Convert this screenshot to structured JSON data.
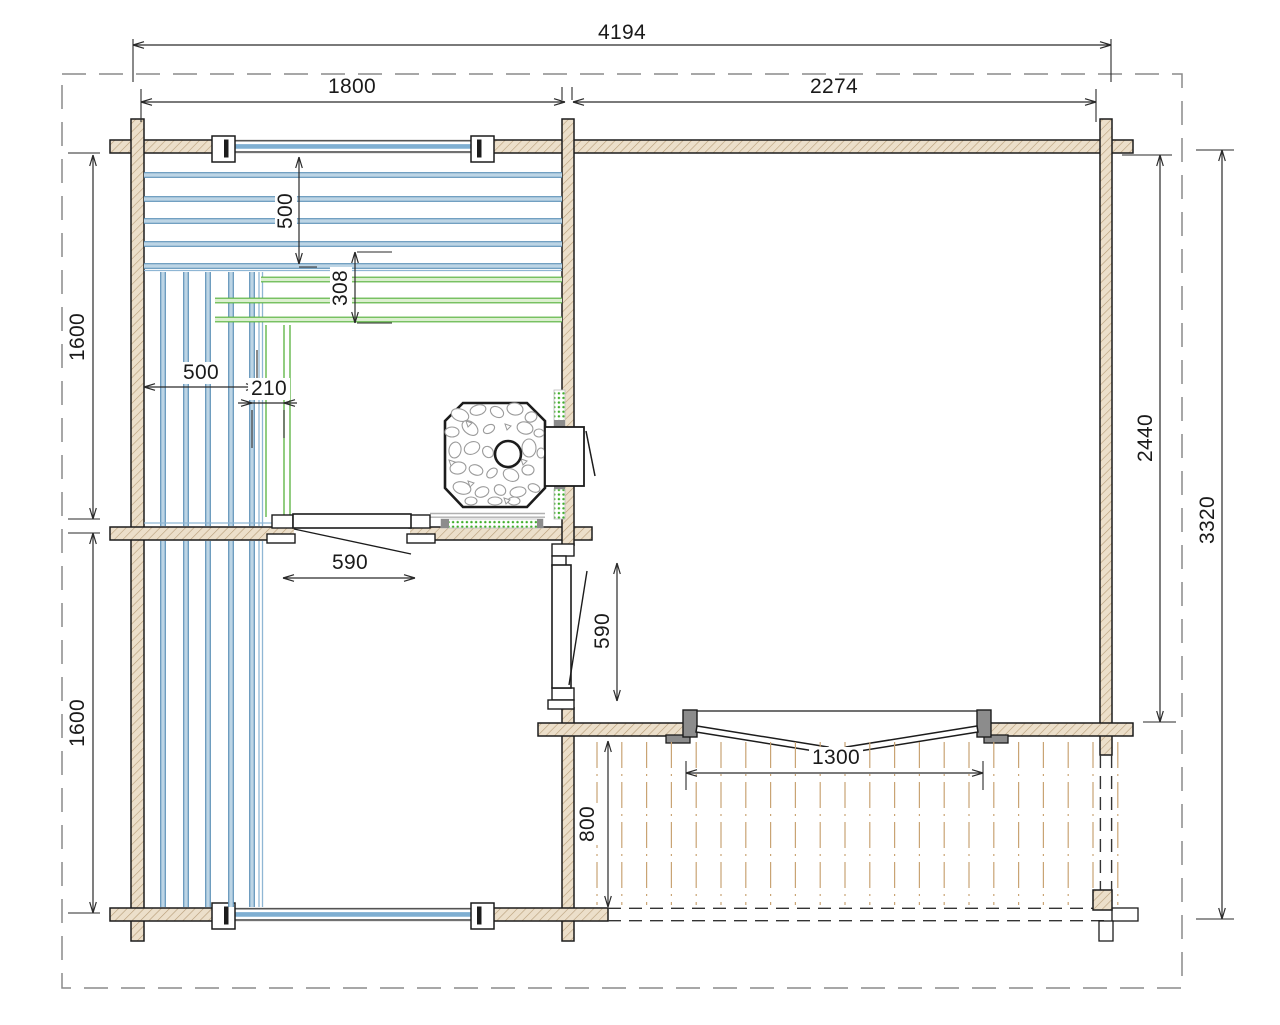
{
  "drawing": {
    "type": "sauna-cabin-floor-plan"
  },
  "dimensions": {
    "overall_width": "4194",
    "sauna_section_width": "1800",
    "main_room_width": "2274",
    "sauna_room_depth": "1600",
    "rear_room_depth": "1600",
    "main_room_depth": "2440",
    "overall_depth": "3320",
    "upper_bench_depth": "500",
    "lower_bench_depth": "308",
    "side_bench_width": "500",
    "bench_step_width": "210",
    "sauna_door_width": "590",
    "passage_door_width": "590",
    "terrace_depth": "800",
    "terrace_door_width": "1300"
  },
  "colors": {
    "wall_fill": "#ecdfca",
    "wall_hatch": "#b79d78",
    "outline": "#1c1c1c",
    "bench_blue": "#5e92b8",
    "bench_blue_light": "#bdd5e5",
    "bench_blue_thin": "#8fb6d4",
    "bench_green": "#57b23d",
    "bench_green_light": "#dcefd0",
    "shield_green": "#3fae2a",
    "deck_plank": "#c9a474",
    "dim_color": "#2a2a2a",
    "boundary_gray": "#8a8a8a",
    "post_gray": "#8c8c8c",
    "glazing_blue": "#7fafd2",
    "metal_gray": "#b0b0b0",
    "stone_gray": "#9b9b9b"
  }
}
